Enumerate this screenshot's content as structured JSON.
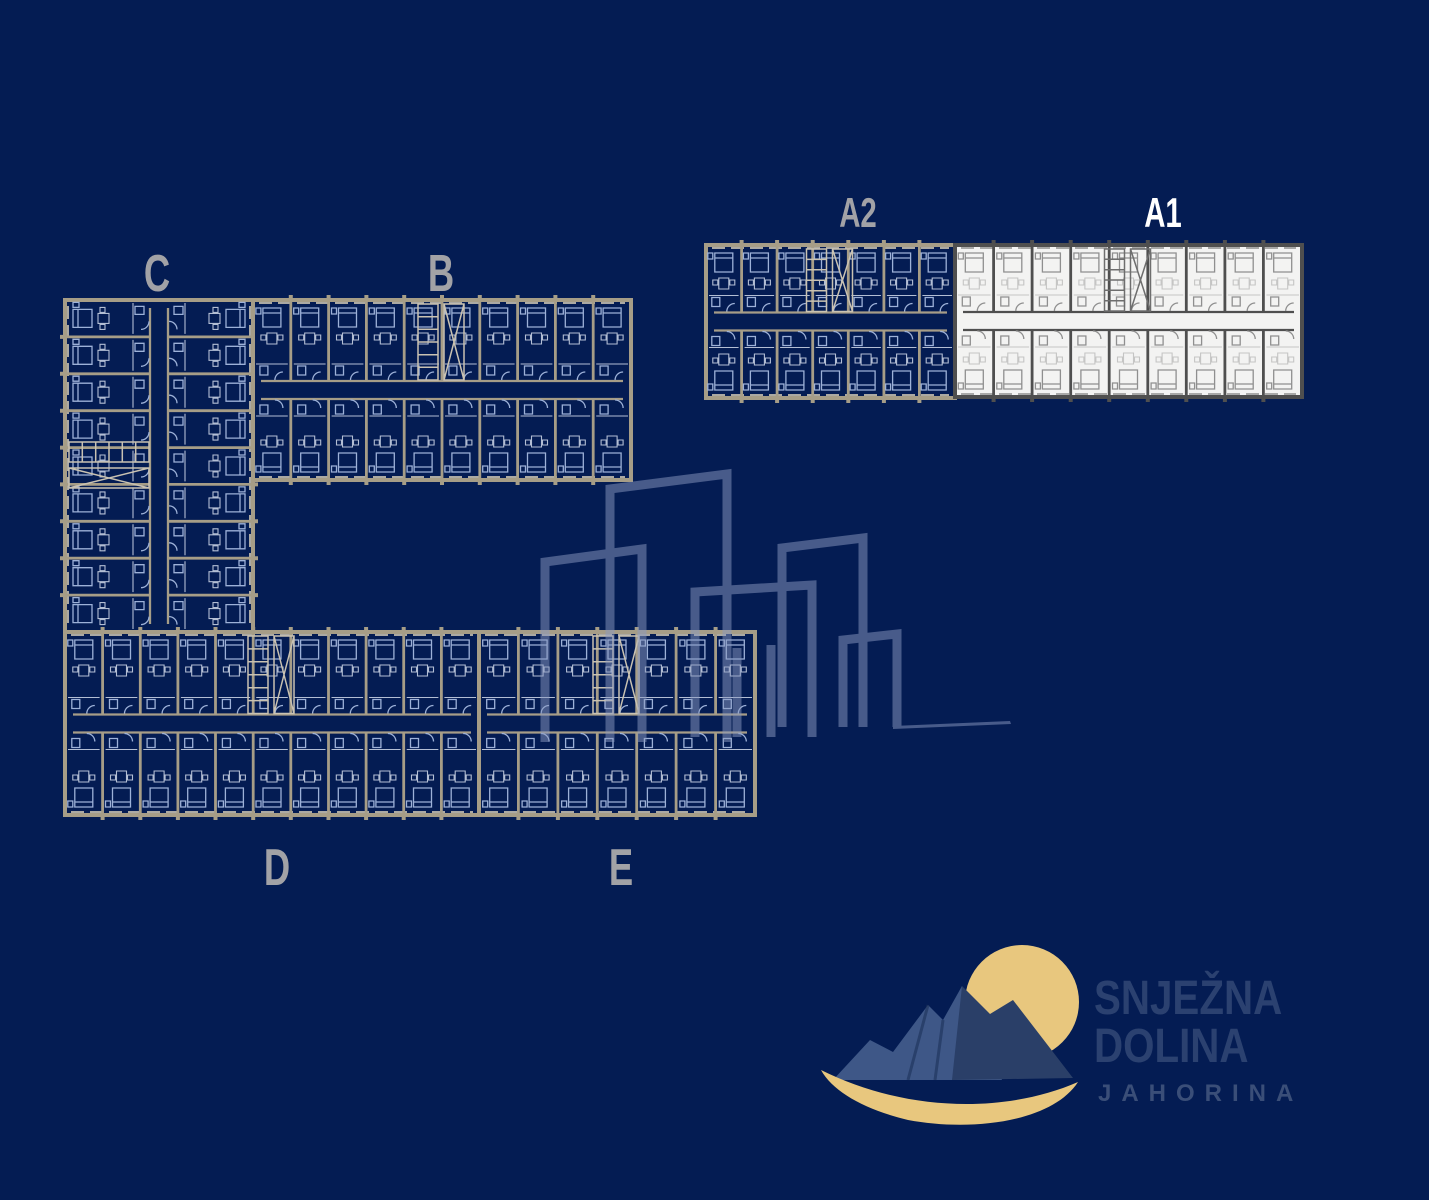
{
  "blocks": [
    {
      "id": "c",
      "label": "C",
      "highlighted": false
    },
    {
      "id": "b",
      "label": "B",
      "highlighted": false
    },
    {
      "id": "a2",
      "label": "A2",
      "highlighted": false
    },
    {
      "id": "a1",
      "label": "A1",
      "highlighted": true
    },
    {
      "id": "d",
      "label": "D",
      "highlighted": false
    },
    {
      "id": "e",
      "label": "E",
      "highlighted": false
    }
  ],
  "logo": {
    "line1": "SNJEŽNA",
    "line2": "DOLINA",
    "line3": "JAHORINA"
  },
  "colors": {
    "background": "#041c53",
    "blueprint_wall": "#a69d87",
    "blueprint_wall_light": "#c9c2b2",
    "blueprint_furniture": "#9db1d8",
    "blueprint_furniture_light": "#d2dbeb",
    "highlight_background": "#f3f3f2",
    "highlight_wall": "#4f4f4f",
    "highlight_furniture": "#8f8f8f",
    "label_gray": "#a2a2a6",
    "label_selected_white": "#ffffff",
    "watermark_blue": "#8b9ac2",
    "accent_gold": "#e8c77e",
    "mountain_light_blue": "#3e5787",
    "mountain_dark_blue": "#2a3f68",
    "logo_text_blue": "#2b4170"
  }
}
